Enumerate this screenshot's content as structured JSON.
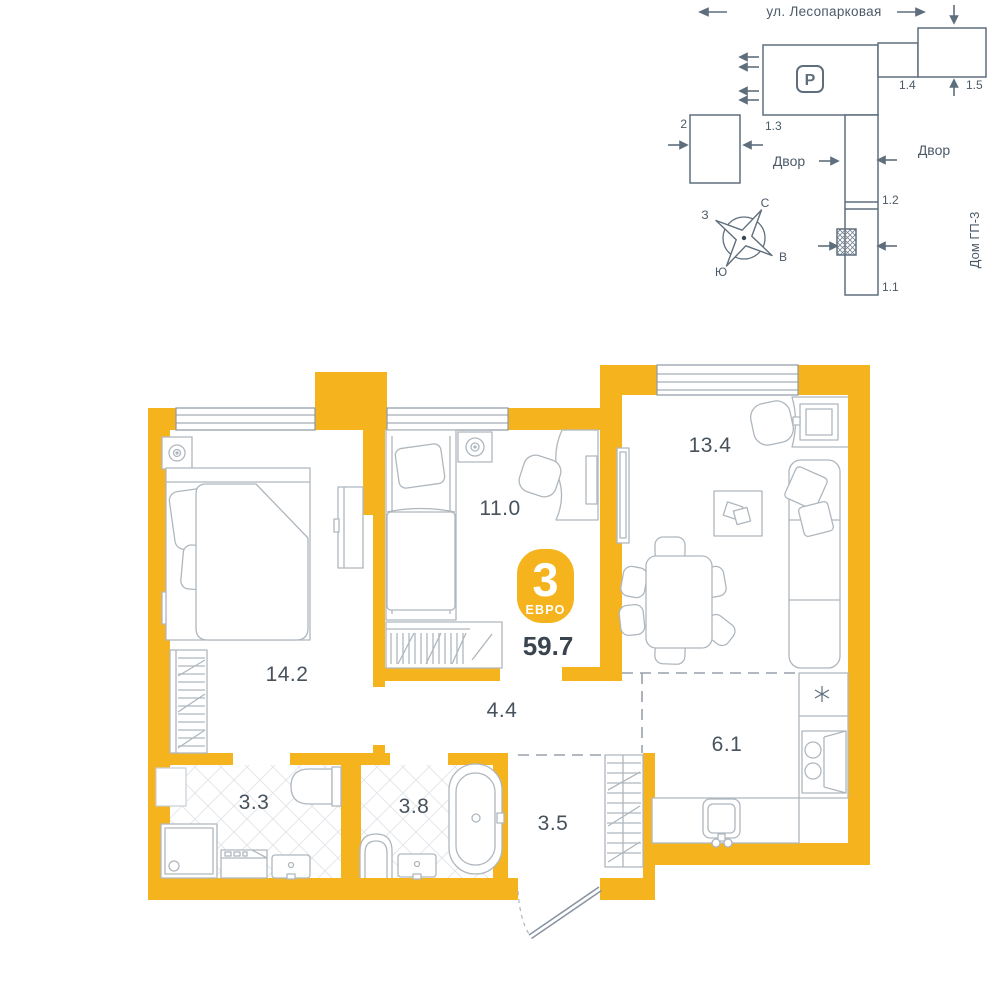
{
  "site_plan": {
    "street": "ул. Лесопарковая",
    "parking_label": "P",
    "buildings": {
      "b2": "2",
      "b13": "1.3",
      "b14": "1.4",
      "b15": "1.5",
      "b12": "1.2",
      "b11": "1.1"
    },
    "yard_left": "Двор",
    "yard_right": "Двор",
    "neighbor_house": "Дом ГП-3",
    "compass": {
      "north": "С",
      "south": "Ю",
      "west": "З",
      "east": "В"
    }
  },
  "apartment": {
    "badge": {
      "rooms_count": "3",
      "layout_type": "ЕВРО",
      "total_area": "59.7"
    },
    "rooms": [
      {
        "name": "bedroom-1",
        "area": "14.2"
      },
      {
        "name": "bedroom-2",
        "area": "11.0"
      },
      {
        "name": "living-room",
        "area": "13.4"
      },
      {
        "name": "corridor",
        "area": "4.4"
      },
      {
        "name": "kitchen",
        "area": "6.1"
      },
      {
        "name": "shower-room",
        "area": "3.3"
      },
      {
        "name": "bathroom",
        "area": "3.8"
      },
      {
        "name": "hallway",
        "area": "3.5"
      }
    ],
    "kitchen_fridge_symbol": "✳"
  },
  "colors": {
    "wall": "#F5B41E",
    "plan_line": "#5F6E7D",
    "furniture_line": "#AFB7BE",
    "label_text": "#47525D",
    "dark_text": "#39444E"
  }
}
